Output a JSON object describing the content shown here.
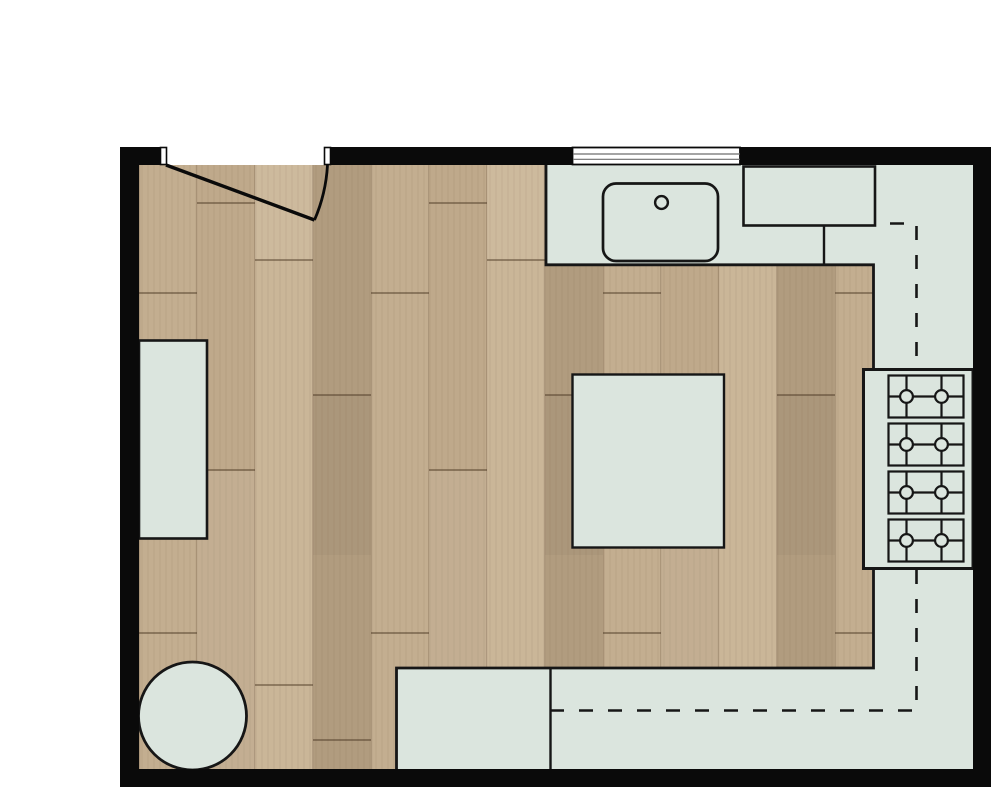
{
  "page": {
    "title": "Kitchen floor plan"
  },
  "colors": {
    "background": "#ffffff",
    "wall": "#0a0a0a",
    "outline": "#161616",
    "counter_fill": "#dbe5de",
    "wood_base": "#bfa98b",
    "wood_light": "#cab698",
    "wood_mid": "#c3ae90",
    "wood_dark": "#b19c7f",
    "plank_edge": "rgba(60,40,20,0.18)",
    "plank_seam": "rgba(70,50,30,0.45)",
    "grain": "rgba(100,75,50,0.10)",
    "window_pane": "#ffffff",
    "window_line": "#6e6e6e"
  },
  "fixtures": {
    "door": {
      "name": "entry-door",
      "swing": "inward"
    },
    "window": {
      "name": "window"
    },
    "sink": {
      "name": "kitchen-sink"
    },
    "faucet": {
      "name": "faucet"
    },
    "appliance": {
      "name": "built-in-appliance"
    },
    "cooktop": {
      "name": "gas-cooktop",
      "burner_rows": 4,
      "burners_per_row": 2
    },
    "island": {
      "name": "kitchen-island"
    },
    "left_counter": {
      "name": "side-cabinet"
    },
    "round_table": {
      "name": "round-table"
    },
    "upper_cabinets": {
      "name": "upper-cabinet-dashed-outline"
    },
    "counters": {
      "name": "kitchen-counter-run"
    }
  }
}
